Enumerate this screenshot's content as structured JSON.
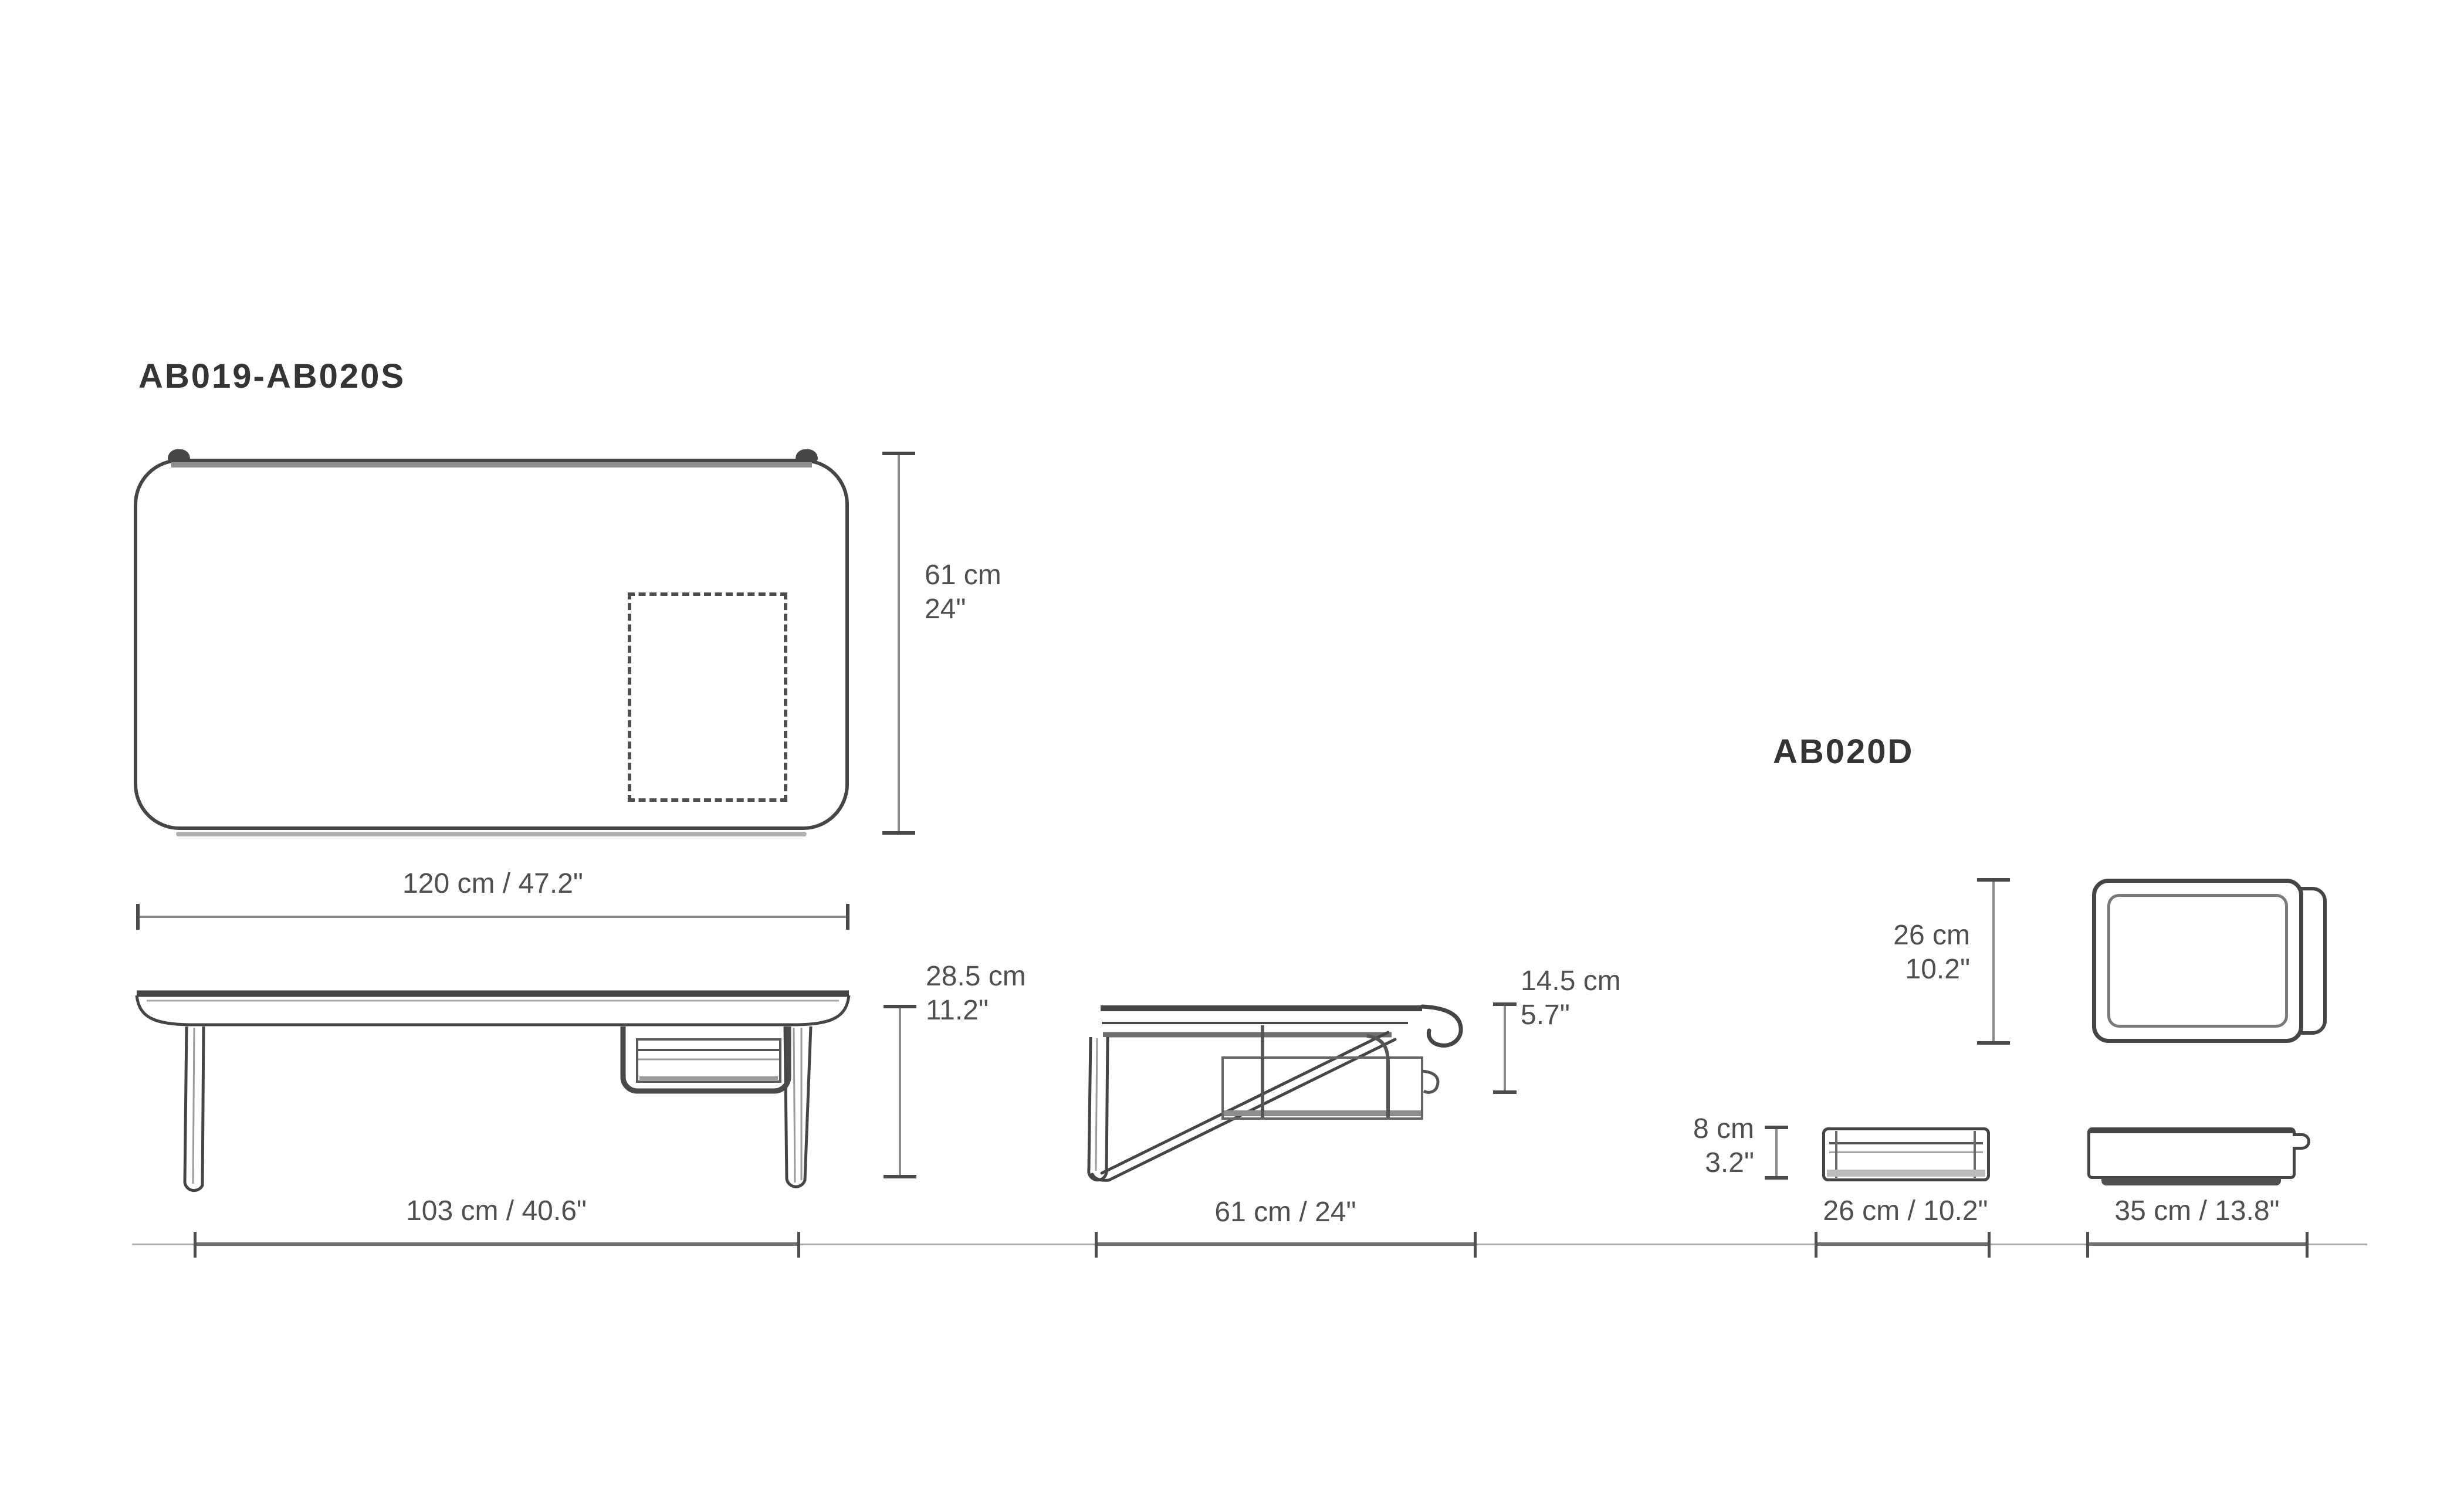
{
  "colors": {
    "ink": "#454545",
    "shadow_gray": "#8d8d8d",
    "dim_line": "#8a8a8a",
    "dim_text": "#4f4f4f",
    "title_text": "#343434",
    "background": "#ffffff"
  },
  "figures": {
    "table": {
      "title": "AB019-AB020S"
    },
    "tray": {
      "title": "AB020D"
    }
  },
  "dims": {
    "top_depth_cm": "61 cm",
    "top_depth_in": "24\"",
    "top_width": "120 cm / 47.2\"",
    "side_height_cm": "28.5 cm",
    "side_height_in": "11.2\"",
    "side_span": "103 cm / 40.6\"",
    "hang_cm": "14.5 cm",
    "hang_in": "5.7\"",
    "end_span": "61 cm / 24\"",
    "square_cm": "26 cm",
    "square_in": "10.2\"",
    "tray_height_cm": "8 cm",
    "tray_height_in": "3.2\"",
    "tray_width": "26 cm / 10.2\"",
    "tray_length": "35 cm / 13.8\""
  }
}
